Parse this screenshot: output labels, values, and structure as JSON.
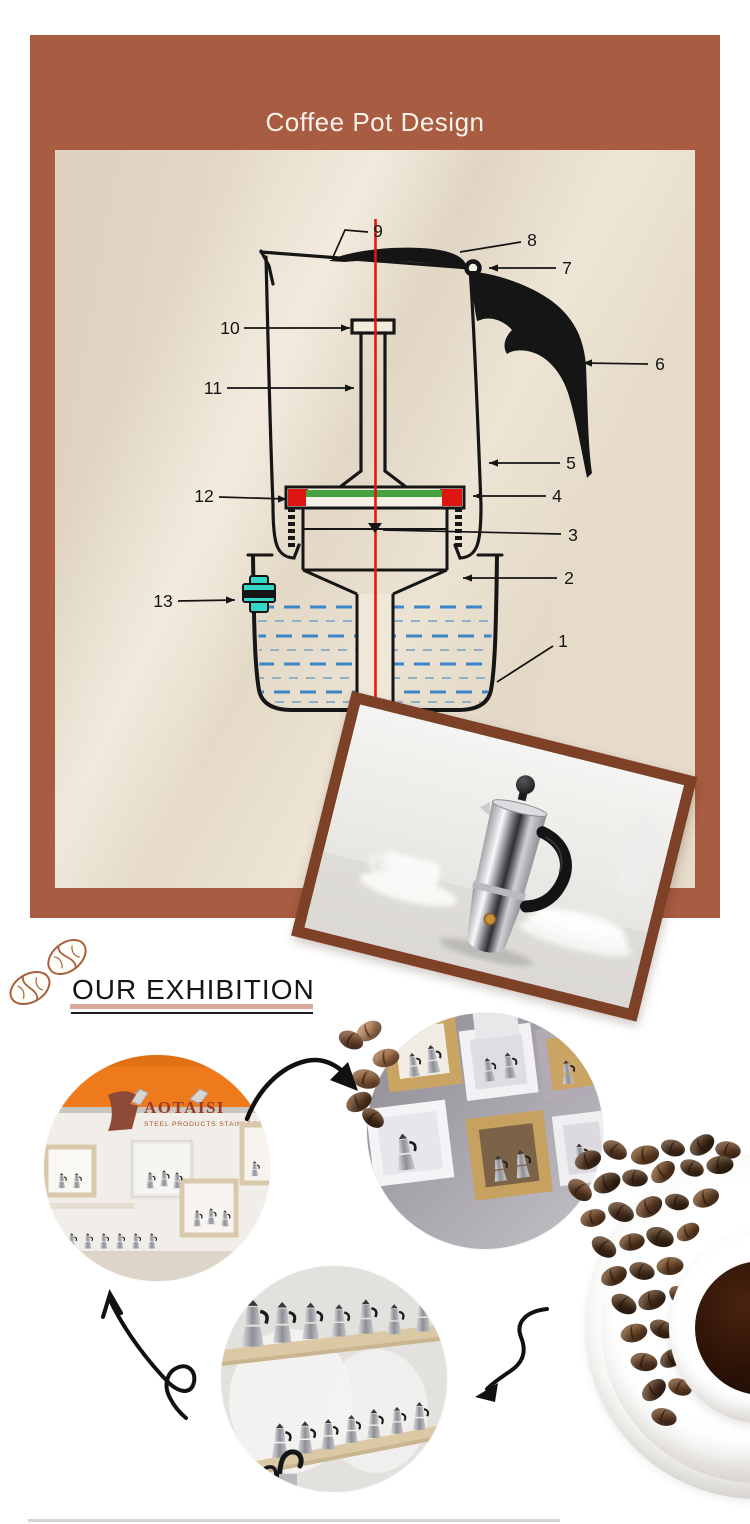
{
  "banner": {
    "title": "Coffee Pot Design",
    "bg": "#a85c41",
    "text_color": "#f8f2ea"
  },
  "diagram": {
    "accent_red": "#e8170e",
    "gasket_red": "#de1510",
    "gasket_green": "#45a241",
    "valve_teal": "#35d6c8",
    "water_blue": "#3a86c8",
    "water_blue_light": "#93afc8",
    "labels": [
      {
        "n": "1",
        "tx": 563,
        "ty": 641,
        "pts": [
          [
            553,
            646
          ],
          [
            497,
            682
          ]
        ],
        "arrow": null
      },
      {
        "n": "2",
        "tx": 569,
        "ty": 578,
        "pts": [
          [
            557,
            578
          ],
          [
            463,
            578
          ]
        ],
        "arrow": "left"
      },
      {
        "n": "3",
        "tx": 573,
        "ty": 535,
        "pts": [
          [
            561,
            534
          ],
          [
            383,
            530
          ]
        ],
        "arrow": null
      },
      {
        "n": "4",
        "tx": 557,
        "ty": 496,
        "pts": [
          [
            546,
            496
          ],
          [
            473,
            496
          ]
        ],
        "arrow": "left"
      },
      {
        "n": "5",
        "tx": 571,
        "ty": 463,
        "pts": [
          [
            560,
            463
          ],
          [
            489,
            463
          ]
        ],
        "arrow": "left"
      },
      {
        "n": "6",
        "tx": 660,
        "ty": 364,
        "pts": [
          [
            648,
            364
          ],
          [
            583,
            363
          ]
        ],
        "arrow": "left"
      },
      {
        "n": "7",
        "tx": 567,
        "ty": 268,
        "pts": [
          [
            556,
            268
          ],
          [
            489,
            268
          ]
        ],
        "arrow": "left"
      },
      {
        "n": "8",
        "tx": 532,
        "ty": 240,
        "pts": [
          [
            521,
            242
          ],
          [
            460,
            252
          ]
        ],
        "arrow": null
      },
      {
        "n": "9",
        "tx": 378,
        "ty": 231,
        "pts": [
          [
            368,
            232
          ],
          [
            345,
            230
          ],
          [
            333,
            257
          ]
        ],
        "arrow": null
      },
      {
        "n": "10",
        "tx": 230,
        "ty": 328,
        "pts": [
          [
            244,
            328
          ],
          [
            350,
            328
          ]
        ],
        "arrow": "right"
      },
      {
        "n": "11",
        "tx": 213,
        "ty": 388,
        "pts": [
          [
            227,
            388
          ],
          [
            354,
            388
          ]
        ],
        "arrow": "right"
      },
      {
        "n": "12",
        "tx": 204,
        "ty": 496,
        "pts": [
          [
            219,
            497
          ],
          [
            287,
            499
          ]
        ],
        "arrow": "right"
      },
      {
        "n": "13",
        "tx": 163,
        "ty": 601,
        "pts": [
          [
            178,
            601
          ],
          [
            235,
            600
          ]
        ],
        "arrow": "right"
      }
    ]
  },
  "exhibition": {
    "heading": "OUR EXHIBITION",
    "underline_pink": "#d9a99c"
  },
  "booth": {
    "brand": "AOTAISI",
    "tagline": "STEEL PRODUCTS STAINLESS"
  },
  "decor": {
    "beans": [
      {
        "x": 369,
        "y": 1031,
        "r": -30,
        "s": 1.0,
        "c": "#b5825e"
      },
      {
        "x": 351,
        "y": 1040,
        "r": 25,
        "s": 0.95,
        "c": "#6e452b"
      },
      {
        "x": 386,
        "y": 1058,
        "r": -12,
        "s": 1.0,
        "c": "#a06a44"
      },
      {
        "x": 366,
        "y": 1079,
        "r": 12,
        "s": 1.05,
        "c": "#8a5a38"
      },
      {
        "x": 359,
        "y": 1102,
        "r": -28,
        "s": 1.0,
        "c": "#5f3c24"
      },
      {
        "x": 373,
        "y": 1118,
        "r": 38,
        "s": 0.9,
        "c": "#4a2e1a"
      },
      {
        "x": 588,
        "y": 1160,
        "r": -20,
        "s": 1.0,
        "c": "#4a2f1d"
      },
      {
        "x": 615,
        "y": 1150,
        "r": 30,
        "s": 0.95,
        "c": "#5d3a22"
      },
      {
        "x": 645,
        "y": 1155,
        "r": -10,
        "s": 1.05,
        "c": "#6b4426"
      },
      {
        "x": 673,
        "y": 1148,
        "r": 15,
        "s": 0.9,
        "c": "#4a2f1d"
      },
      {
        "x": 702,
        "y": 1145,
        "r": -35,
        "s": 1.0,
        "c": "#3f2815"
      },
      {
        "x": 728,
        "y": 1150,
        "r": 10,
        "s": 0.95,
        "c": "#5d3a22"
      },
      {
        "x": 580,
        "y": 1190,
        "r": 40,
        "s": 1.0,
        "c": "#5d3a22"
      },
      {
        "x": 607,
        "y": 1183,
        "r": -25,
        "s": 1.05,
        "c": "#3f2815"
      },
      {
        "x": 635,
        "y": 1178,
        "r": 5,
        "s": 0.95,
        "c": "#4a2f1d"
      },
      {
        "x": 663,
        "y": 1172,
        "r": -40,
        "s": 1.0,
        "c": "#6b4426"
      },
      {
        "x": 692,
        "y": 1168,
        "r": 20,
        "s": 0.9,
        "c": "#4a2f1d"
      },
      {
        "x": 720,
        "y": 1165,
        "r": -5,
        "s": 1.0,
        "c": "#3f2815"
      },
      {
        "x": 593,
        "y": 1218,
        "r": -15,
        "s": 0.95,
        "c": "#6b4426"
      },
      {
        "x": 621,
        "y": 1212,
        "r": 25,
        "s": 1.0,
        "c": "#4a2f1d"
      },
      {
        "x": 649,
        "y": 1207,
        "r": -30,
        "s": 1.05,
        "c": "#5d3a22"
      },
      {
        "x": 677,
        "y": 1202,
        "r": 10,
        "s": 0.9,
        "c": "#3f2815"
      },
      {
        "x": 706,
        "y": 1198,
        "r": -20,
        "s": 1.0,
        "c": "#6b4426"
      },
      {
        "x": 604,
        "y": 1247,
        "r": 35,
        "s": 1.0,
        "c": "#4a2f1d"
      },
      {
        "x": 632,
        "y": 1242,
        "r": -10,
        "s": 0.95,
        "c": "#5d3a22"
      },
      {
        "x": 660,
        "y": 1237,
        "r": 20,
        "s": 1.05,
        "c": "#3f2815"
      },
      {
        "x": 688,
        "y": 1232,
        "r": -30,
        "s": 0.9,
        "c": "#6b4426"
      },
      {
        "x": 614,
        "y": 1276,
        "r": -25,
        "s": 1.0,
        "c": "#5d3a22"
      },
      {
        "x": 642,
        "y": 1271,
        "r": 15,
        "s": 0.95,
        "c": "#4a2f1d"
      },
      {
        "x": 670,
        "y": 1266,
        "r": -5,
        "s": 1.0,
        "c": "#6b4426"
      },
      {
        "x": 624,
        "y": 1304,
        "r": 30,
        "s": 1.0,
        "c": "#3f2815"
      },
      {
        "x": 652,
        "y": 1300,
        "r": -20,
        "s": 1.05,
        "c": "#4a2f1d"
      },
      {
        "x": 680,
        "y": 1296,
        "r": 40,
        "s": 0.9,
        "c": "#5d3a22"
      },
      {
        "x": 634,
        "y": 1333,
        "r": -15,
        "s": 1.0,
        "c": "#6b4426"
      },
      {
        "x": 662,
        "y": 1329,
        "r": 25,
        "s": 0.95,
        "c": "#4a2f1d"
      },
      {
        "x": 644,
        "y": 1362,
        "r": 10,
        "s": 1.0,
        "c": "#5d3a22"
      },
      {
        "x": 672,
        "y": 1358,
        "r": -30,
        "s": 0.95,
        "c": "#3f2815"
      },
      {
        "x": 654,
        "y": 1390,
        "r": -40,
        "s": 1.0,
        "c": "#4a2f1d"
      },
      {
        "x": 680,
        "y": 1387,
        "r": 20,
        "s": 0.9,
        "c": "#6b4426"
      },
      {
        "x": 664,
        "y": 1417,
        "r": 15,
        "s": 0.95,
        "c": "#5d3a22"
      }
    ]
  }
}
